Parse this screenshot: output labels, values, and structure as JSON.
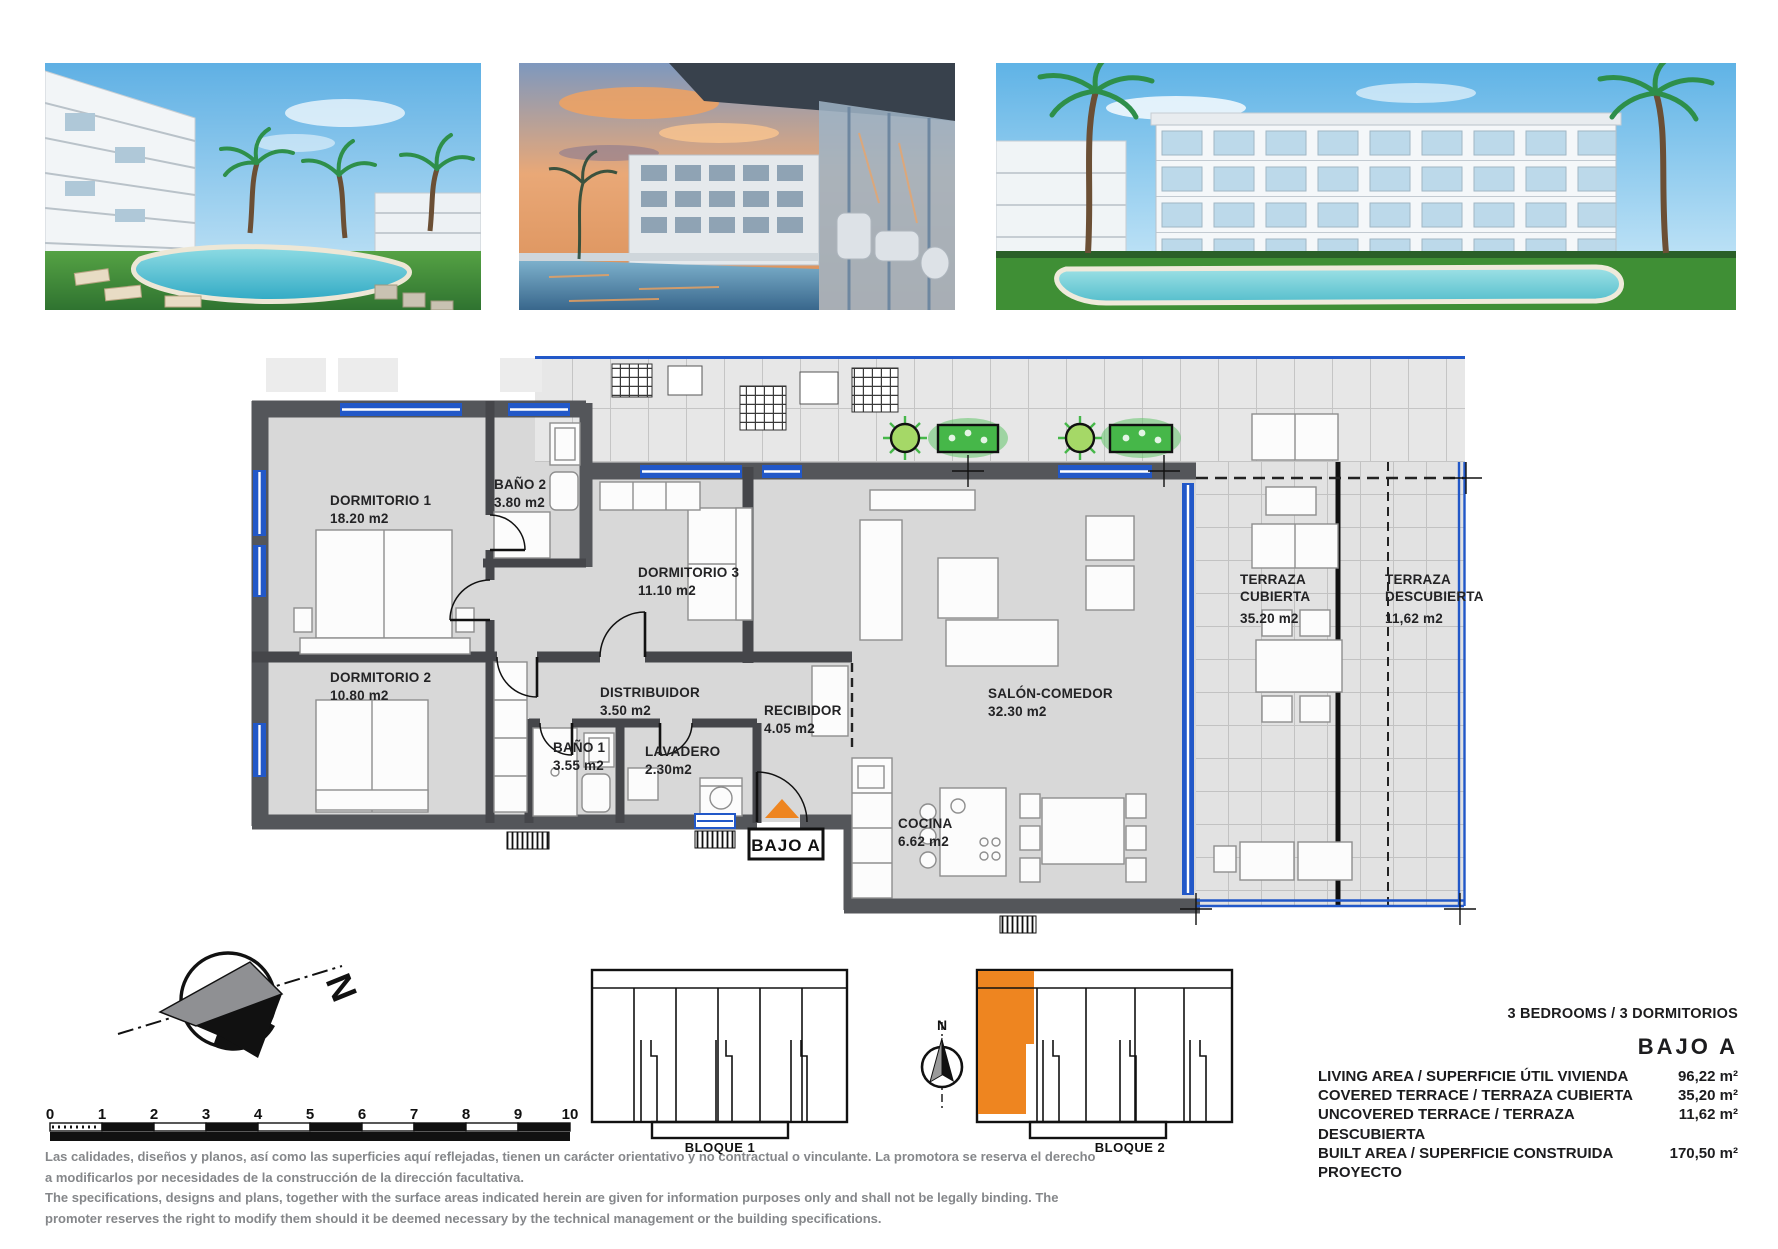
{
  "floor_plan": {
    "unit_label": "BAJO A",
    "rooms": [
      {
        "label": [
          "DORMITORIO 1"
        ],
        "area": "18.20 m2"
      },
      {
        "label": [
          "BAÑO 2"
        ],
        "area": "3.80 m2"
      },
      {
        "label": [
          "DORMITORIO 3"
        ],
        "area": "11.10 m2"
      },
      {
        "label": [
          "DORMITORIO 2"
        ],
        "area": "10.80 m2"
      },
      {
        "label": [
          "DISTRIBUIDOR"
        ],
        "area": "3.50 m2"
      },
      {
        "label": [
          "BAÑO 1"
        ],
        "area": "3.55 m2"
      },
      {
        "label": [
          "LAVADERO"
        ],
        "area": "2.30m2"
      },
      {
        "label": [
          "RECIBIDOR"
        ],
        "area": "4.05 m2"
      },
      {
        "label": [
          "COCINA"
        ],
        "area": "6.62 m2"
      },
      {
        "label": [
          "SALÓN-COMEDOR"
        ],
        "area": "32.30 m2"
      },
      {
        "label": [
          "TERRAZA",
          "CUBIERTA"
        ],
        "area": "35.20 m2"
      },
      {
        "label": [
          "TERRAZA",
          "DESCUBIERTA"
        ],
        "area": "11,62 m2"
      }
    ]
  },
  "site": {
    "block1": "BLOQUE 1",
    "block2": "BLOQUE 2",
    "north": "N"
  },
  "scale_bar": {
    "ticks": [
      "0",
      "1",
      "2",
      "3",
      "4",
      "5",
      "6",
      "7",
      "8",
      "9",
      "10"
    ]
  },
  "specs": {
    "type_line": "3 BEDROOMS / 3 DORMITORIOS",
    "unit": "BAJO A",
    "rows": [
      {
        "label": "LIVING AREA / SUPERFICIE ÚTIL VIVIENDA",
        "value": "96,22 m²"
      },
      {
        "label": "COVERED TERRACE / TERRAZA CUBIERTA",
        "value": "35,20 m²"
      },
      {
        "label": "UNCOVERED TERRACE / TERRAZA DESCUBIERTA",
        "value": "11,62 m²"
      },
      {
        "label": "BUILT AREA / SUPERFICIE CONSTRUIDA PROYECTO",
        "value": "170,50 m²"
      }
    ]
  },
  "disclaimer": {
    "es": "Las calidades, diseños y planos, así como las superficies aquí reflejadas, tienen un carácter orientativo y no contractual o vinculante. La promotora se reserva el derecho a modificarlos por necesidades de la construcción de la dirección facultativa.",
    "en": "The specifications, designs and plans, together with the surface areas indicated herein are given for information purposes only and shall not be legally binding. The promoter reserves the right to modify them should it be deemed necessary by the technical management or the building specifications."
  },
  "colors": {
    "accent_orange": "#EE8520",
    "wall_gray": "#54565A",
    "window_blue": "#2258C8",
    "plant_green": "#46B749",
    "floor_gray": "#D8D8D8"
  }
}
